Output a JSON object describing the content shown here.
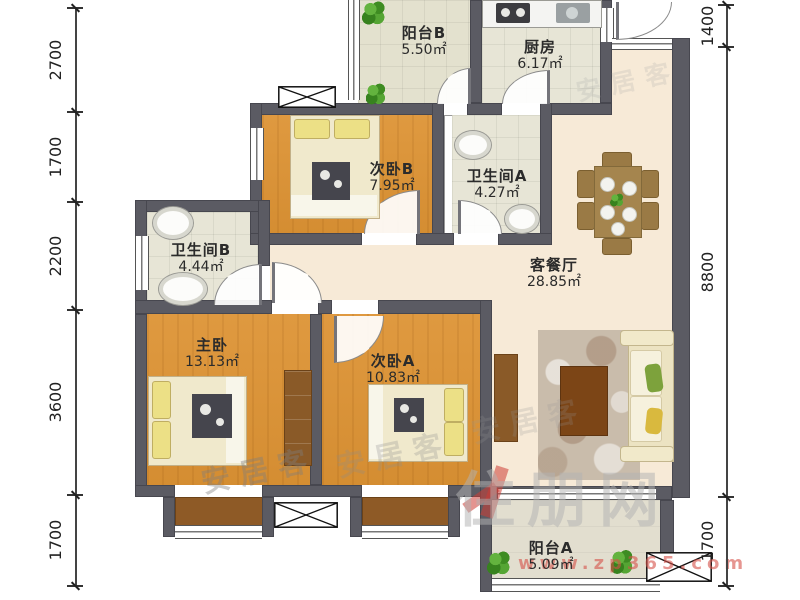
{
  "floor_plan": {
    "rooms": [
      {
        "key": "balcony-b",
        "name": "阳台B",
        "area": "5.50㎡"
      },
      {
        "key": "kitchen",
        "name": "厨房",
        "area": "6.17㎡"
      },
      {
        "key": "bedroom-b",
        "name": "次卧B",
        "area": "7.95㎡"
      },
      {
        "key": "bathroom-a",
        "name": "卫生间A",
        "area": "4.27㎡"
      },
      {
        "key": "bathroom-b",
        "name": "卫生间B",
        "area": "4.44㎡"
      },
      {
        "key": "living-dining",
        "name": "客餐厅",
        "area": "28.85㎡"
      },
      {
        "key": "master-bedroom",
        "name": "主卧",
        "area": "13.13㎡"
      },
      {
        "key": "bedroom-a",
        "name": "次卧A",
        "area": "10.83㎡"
      },
      {
        "key": "balcony-a",
        "name": "阳台A",
        "area": "5.09㎡"
      }
    ],
    "dimensions_left": [
      "2700",
      "1700",
      "2200",
      "3600",
      "1700"
    ],
    "dimensions_right": [
      "1400",
      "8800",
      "1700"
    ],
    "watermarks": {
      "agency": "安居客",
      "site": "住朋网",
      "site_url": "www.zp365.com"
    },
    "colors": {
      "wall": "#5b5b63",
      "wood_floor": "#dd9334",
      "tile_floor": "#e7e5d6",
      "living_floor": "#f7ead7",
      "balcony_floor": "#e2decf",
      "bay_window_floor": "#8e5a26",
      "furniture_wood": "#a5854e",
      "watermark_red": "#cc4437"
    }
  }
}
